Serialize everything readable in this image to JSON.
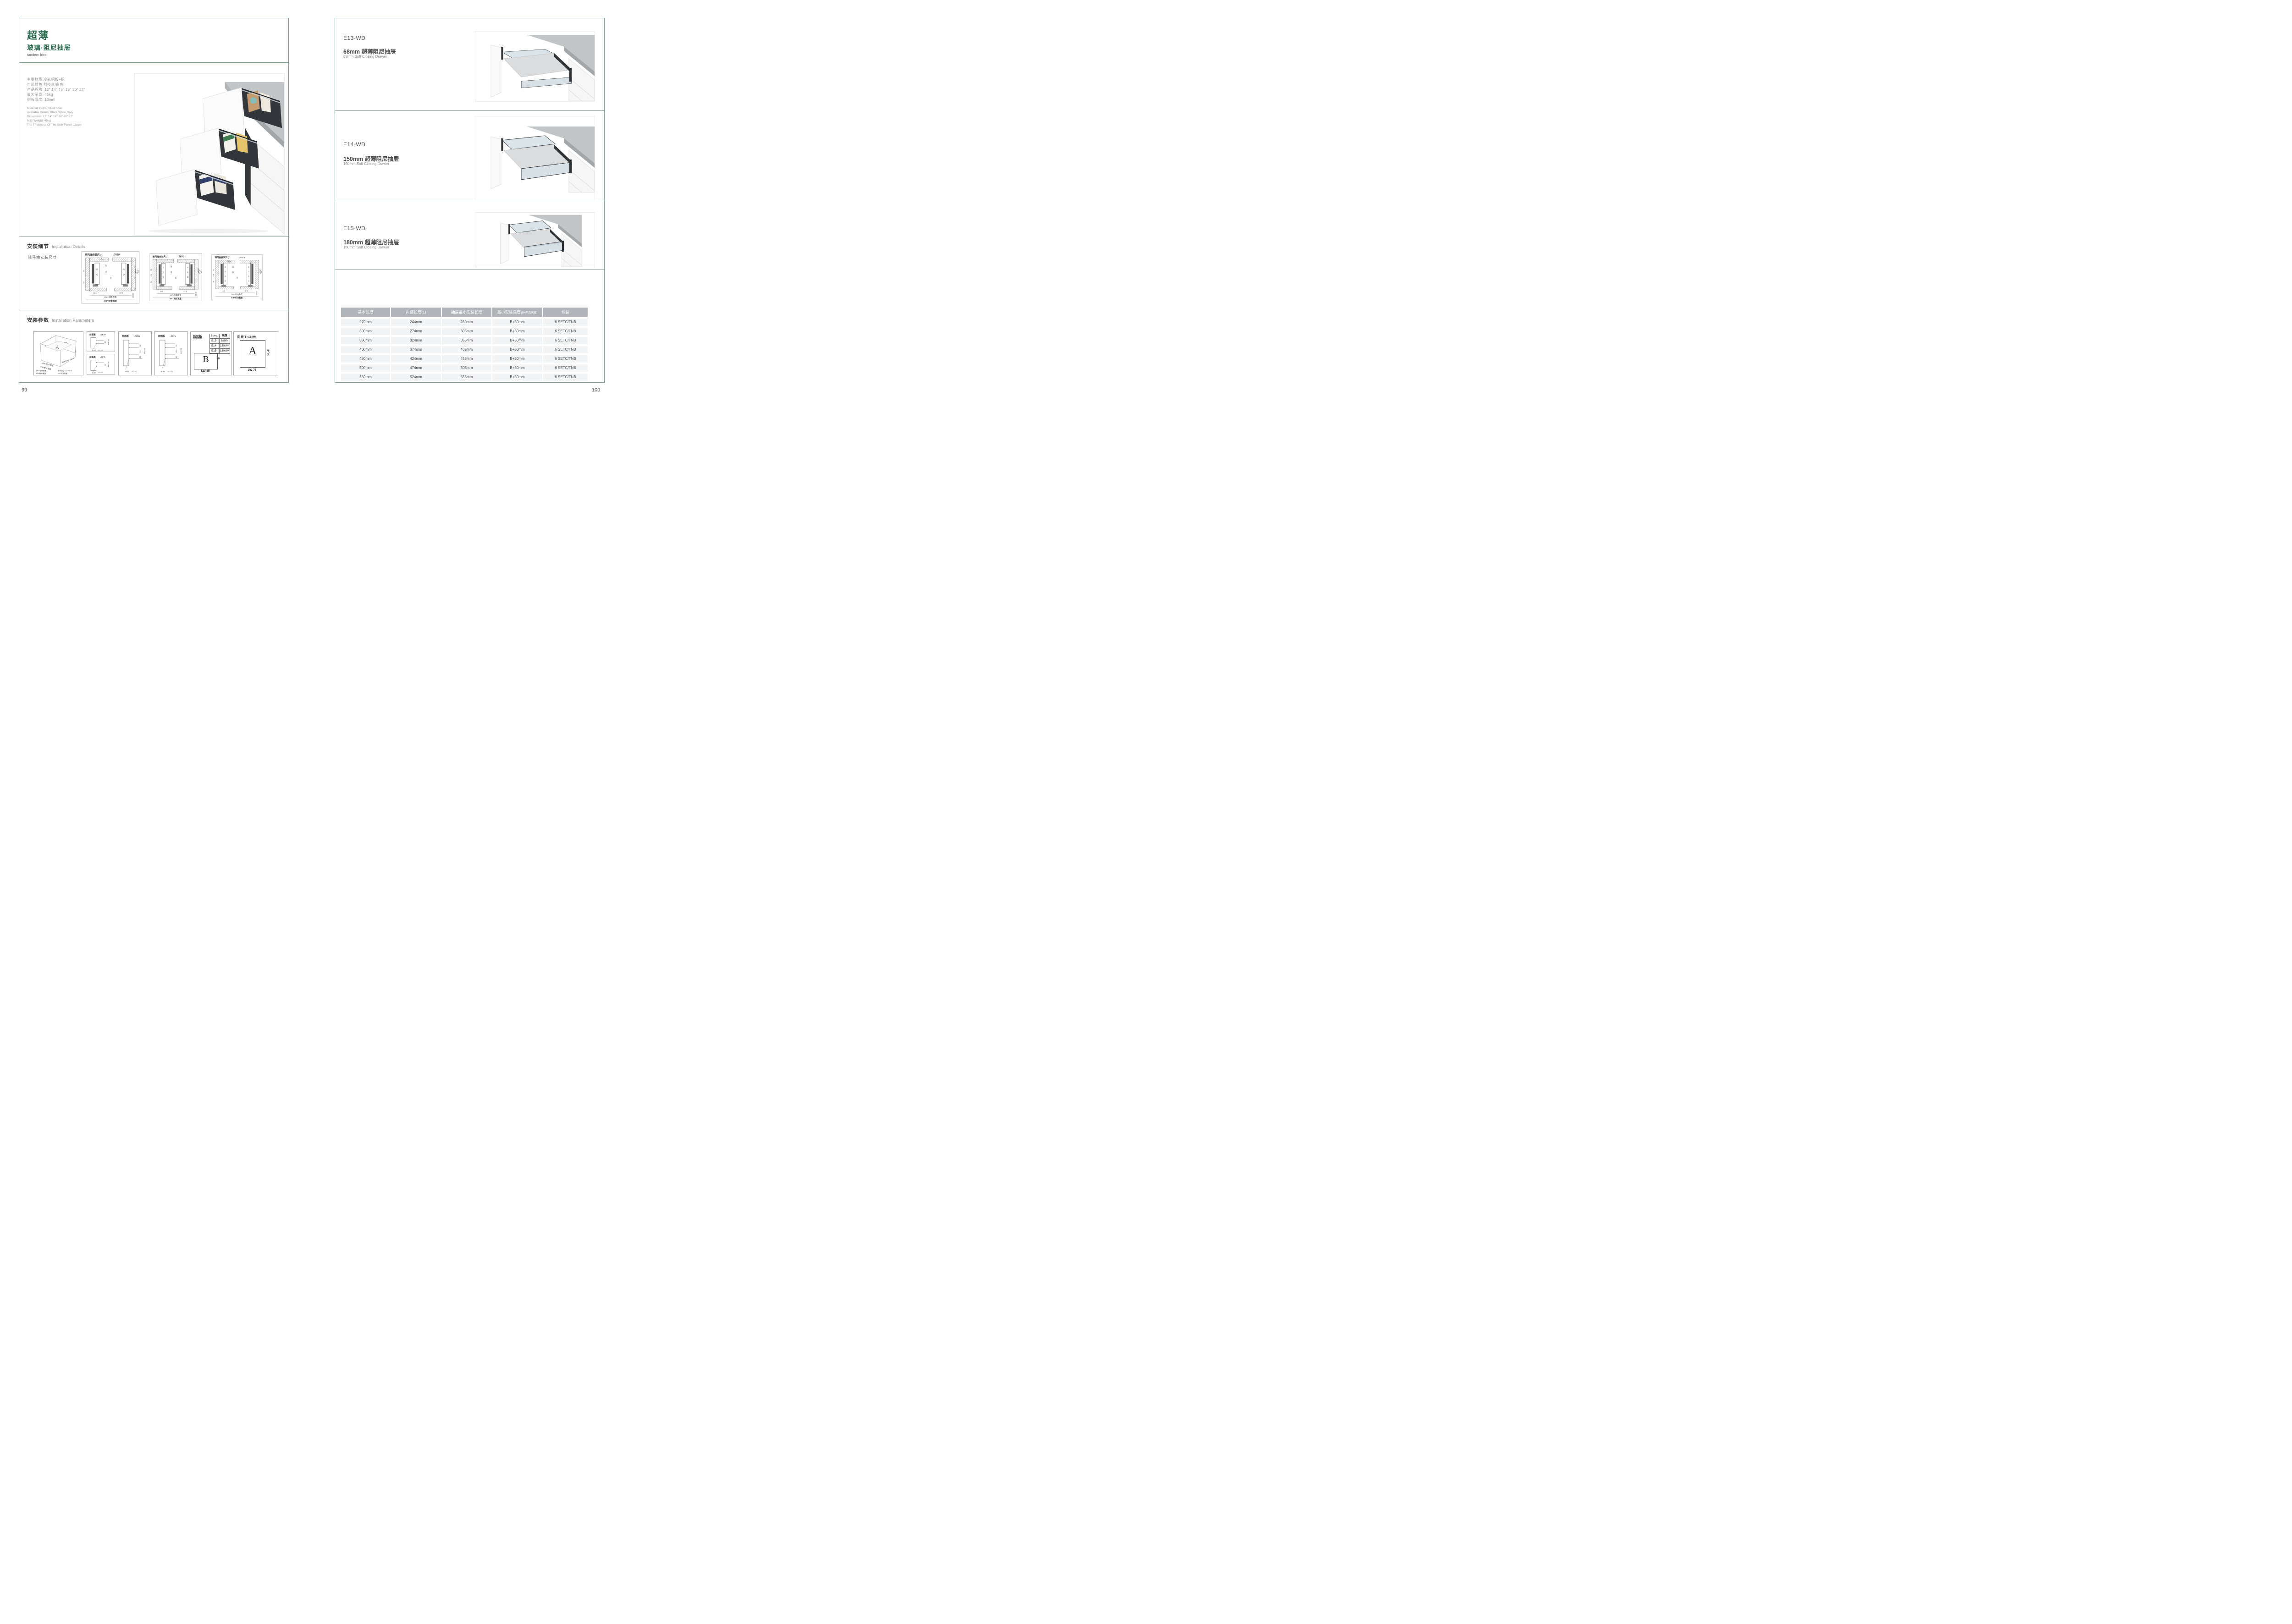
{
  "colors": {
    "accent_green": "#2c6a4f",
    "border_green": "#7aa089",
    "table_header_bg": "#b1b4b9",
    "row_bg": "#f3f4f6"
  },
  "left_page": {
    "page_number": "99",
    "title_zh": "超薄",
    "subtitle_zh": "玻璃·阻尼抽屉",
    "title_en": "tandem box",
    "specs_zh": [
      "主要材质:冷轧钢板+铝",
      "可选颜色:科技灰/白色",
      "产品规格: 12\" 14\" 16\" 18\" 20\" 22\"",
      "最大承重: 45kg",
      "侧板厚度; 13mm"
    ],
    "specs_en": [
      "Material: Cold-Rolled Steel",
      "Available Colors: Black,White,Gray",
      "Dimension: 12\" 14\" 16\" 18\" 20\" 22\"",
      "Max Weight: 45kg",
      "The Thickness Of The Side Panel: 13mm"
    ],
    "install_details": {
      "heading_zh": "安装细节",
      "heading_en": "Installation Details",
      "subheading": "骑马抽安装尺寸"
    },
    "diagrams": {
      "p": {
        "title": "骑马抽安装尺寸",
        "model": "-707P",
        "t1": "9",
        "t2": "20",
        "t3": "32",
        "l1": "32",
        "l2": "",
        "l3": "54",
        "c1": "16",
        "r1": "Min82",
        "r2": "91.50",
        "r3": "113",
        "b1": "16.5",
        "b2": "37.5",
        "b3": "Min36",
        "lw": "LW=柜体净宽",
        "kb": "KB=柜体宽度"
      },
      "g": {
        "title": "骑马抽安装尺寸",
        "model": "-707G",
        "t1": "9",
        "t2": "20",
        "t3": "32",
        "l1": "32",
        "l2": "6.4",
        "l3": "54",
        "c1": "16",
        "r1": "Min162",
        "r2": "171.50",
        "r3": "195",
        "b1": "16.5",
        "b2": "37.5",
        "b3": "Min36",
        "lw": "LW=柜体净宽",
        "kb": "KB=柜体宽度"
      },
      "h": {
        "title": "骑马抽安装尺寸",
        "model": "-707H",
        "t1": "9",
        "t2": "20",
        "t3": "32",
        "l1": "32",
        "l2": "6.4",
        "l3": "54",
        "c1": "16",
        "r1": "Min192",
        "r2": "201.50",
        "r3": "225",
        "b1": "16.5",
        "b2": "37.5",
        "b3": "Min36",
        "lw": "LW=柜体净宽",
        "kb": "KB=柜体宽度"
      }
    },
    "install_params": {
      "heading_zh": "安装参数",
      "heading_en": "Installation Parameters"
    },
    "iso": {
      "letter_b": "B",
      "letter_a": "A",
      "edge_lw": "LW=柜体净宽",
      "edge_kb": "KB=柜体宽度",
      "edge_lt": "柜体内空LT=NL+3",
      "legend": [
        "LW=柜体净宽",
        "柜体内空: LT=NL+3",
        "KB=柜体宽度",
        "NL=标准长度"
      ]
    },
    "panels": {
      "p": {
        "title": "前面板",
        "model": "-707P",
        "d1": "32",
        "dmin": "min 54",
        "holes": "2-ø2",
        "tol": "+0.2 -0.1"
      },
      "l": {
        "title": "前面板",
        "model": "-707L",
        "d1": "32",
        "dmin": "min 54",
        "holes": "2-ø2",
        "tol": "+0.2 -0.1"
      },
      "g": {
        "title": "前面板",
        "model": "-707G",
        "d1": "32",
        "d2": "64",
        "d3": "32",
        "dmin": "min 54",
        "holes": "4-ø2",
        "tol": "+0.2 -0.1"
      },
      "h": {
        "title": "前面板",
        "model": "-707H",
        "d1": "32",
        "d2": "64",
        "d3": "32",
        "dmin": "min 54",
        "holes": "4-ø2",
        "tol": "+0.2 -0.1"
      }
    },
    "back_panel": {
      "title": "后背板",
      "thickness": "T=16MM",
      "spec_header": [
        "Spec.",
        "高度"
      ],
      "spec_rows": [
        [
          "E13-WD",
          "68MM"
        ],
        [
          "E14-WD",
          "150MM"
        ],
        [
          "E15-WD",
          "180MM"
        ]
      ],
      "letter": "B",
      "h_label": "H",
      "w_label": "LW-85"
    },
    "bottom_panel": {
      "title": "底 板 T=16MM",
      "letter": "A",
      "side_label": "NL-6",
      "w_label": "LW-75"
    }
  },
  "right_page": {
    "page_number": "100",
    "sections": [
      {
        "model": "E13-WD",
        "name_zh": "68mm 超薄阻尼抽屉",
        "name_en": "68mm Soft Closing Drawer"
      },
      {
        "model": "E14-WD",
        "name_zh": "150mm 超薄阻尼抽屉",
        "name_en": "150mm Soft Closing Drawer"
      },
      {
        "model": "E15-WD",
        "name_zh": "180mm 超薄阻尼抽屉",
        "name_en": "180mm Soft Closing Drawer"
      }
    ],
    "table": {
      "headers": [
        "基本长度",
        "内部长度(L)",
        "抽屉最小安装长度",
        "最小安装高度",
        "包装"
      ],
      "header4_note": "(B=产品高度)",
      "rows": [
        [
          "270mm",
          "244mm",
          "280mm",
          "B+50mm",
          "6 SETC/TNB"
        ],
        [
          "300mm",
          "274mm",
          "305mm",
          "B+50mm",
          "6 SETC/TNB"
        ],
        [
          "350mm",
          "324mm",
          "355mm",
          "B+50mm",
          "6 SETC/TNB"
        ],
        [
          "400mm",
          "374mm",
          "405mm",
          "B+50mm",
          "6 SETC/TNB"
        ],
        [
          "450mm",
          "424mm",
          "455mm",
          "B+50mm",
          "6 SETC/TNB"
        ],
        [
          "500mm",
          "474mm",
          "505mm",
          "B+50mm",
          "6 SETC/TNB"
        ],
        [
          "550mm",
          "524mm",
          "555mm",
          "B+50mm",
          "6 SETC/TNB"
        ]
      ]
    }
  }
}
